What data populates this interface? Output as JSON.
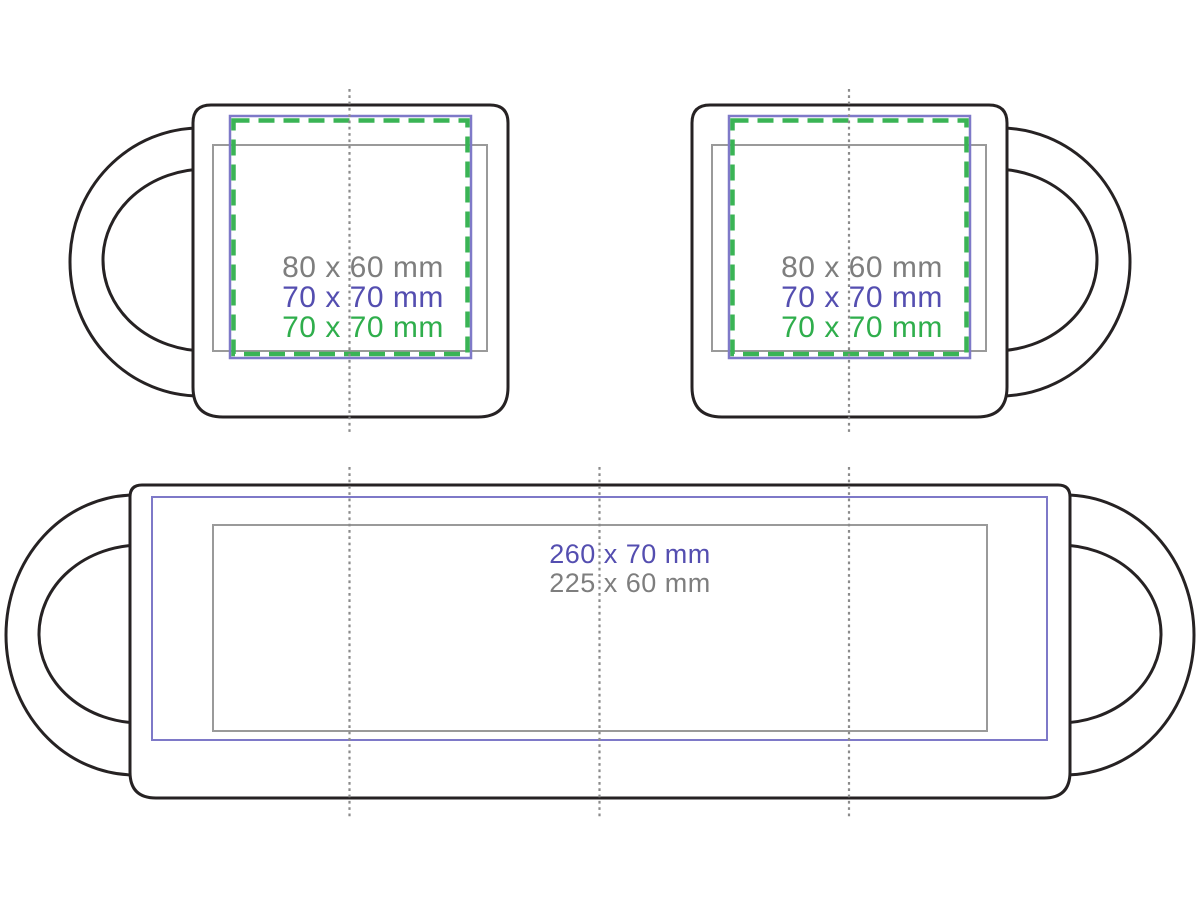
{
  "colors": {
    "mug_outline": "#262223",
    "print_area_gray": "#9a9a9a",
    "print_area_blue": "#7e79c8",
    "print_area_green": "#3ab455",
    "label_gray": "#7e7e7e",
    "label_blue": "#544eb0",
    "label_green": "#2fae4c",
    "guide_line": "#8b8b8b",
    "background": "#ffffff"
  },
  "side_view_left": {
    "print_areas": [
      {
        "label": "80 x 60 mm",
        "width_mm": 80,
        "height_mm": 60,
        "line_style": "solid-gray"
      },
      {
        "label": "70 x 70 mm",
        "width_mm": 70,
        "height_mm": 70,
        "line_style": "solid-blue"
      },
      {
        "label": "70 x 70 mm",
        "width_mm": 70,
        "height_mm": 70,
        "line_style": "dashed-green"
      }
    ]
  },
  "side_view_right": {
    "print_areas": [
      {
        "label": "80 x 60 mm",
        "width_mm": 80,
        "height_mm": 60,
        "line_style": "solid-gray"
      },
      {
        "label": "70 x 70 mm",
        "width_mm": 70,
        "height_mm": 70,
        "line_style": "solid-blue"
      },
      {
        "label": "70 x 70 mm",
        "width_mm": 70,
        "height_mm": 70,
        "line_style": "dashed-green"
      }
    ]
  },
  "wrap_view": {
    "print_areas": [
      {
        "label": "260 x 70 mm",
        "width_mm": 260,
        "height_mm": 70,
        "line_style": "solid-blue"
      },
      {
        "label": "225 x 60 mm",
        "width_mm": 225,
        "height_mm": 60,
        "line_style": "solid-gray"
      }
    ]
  }
}
